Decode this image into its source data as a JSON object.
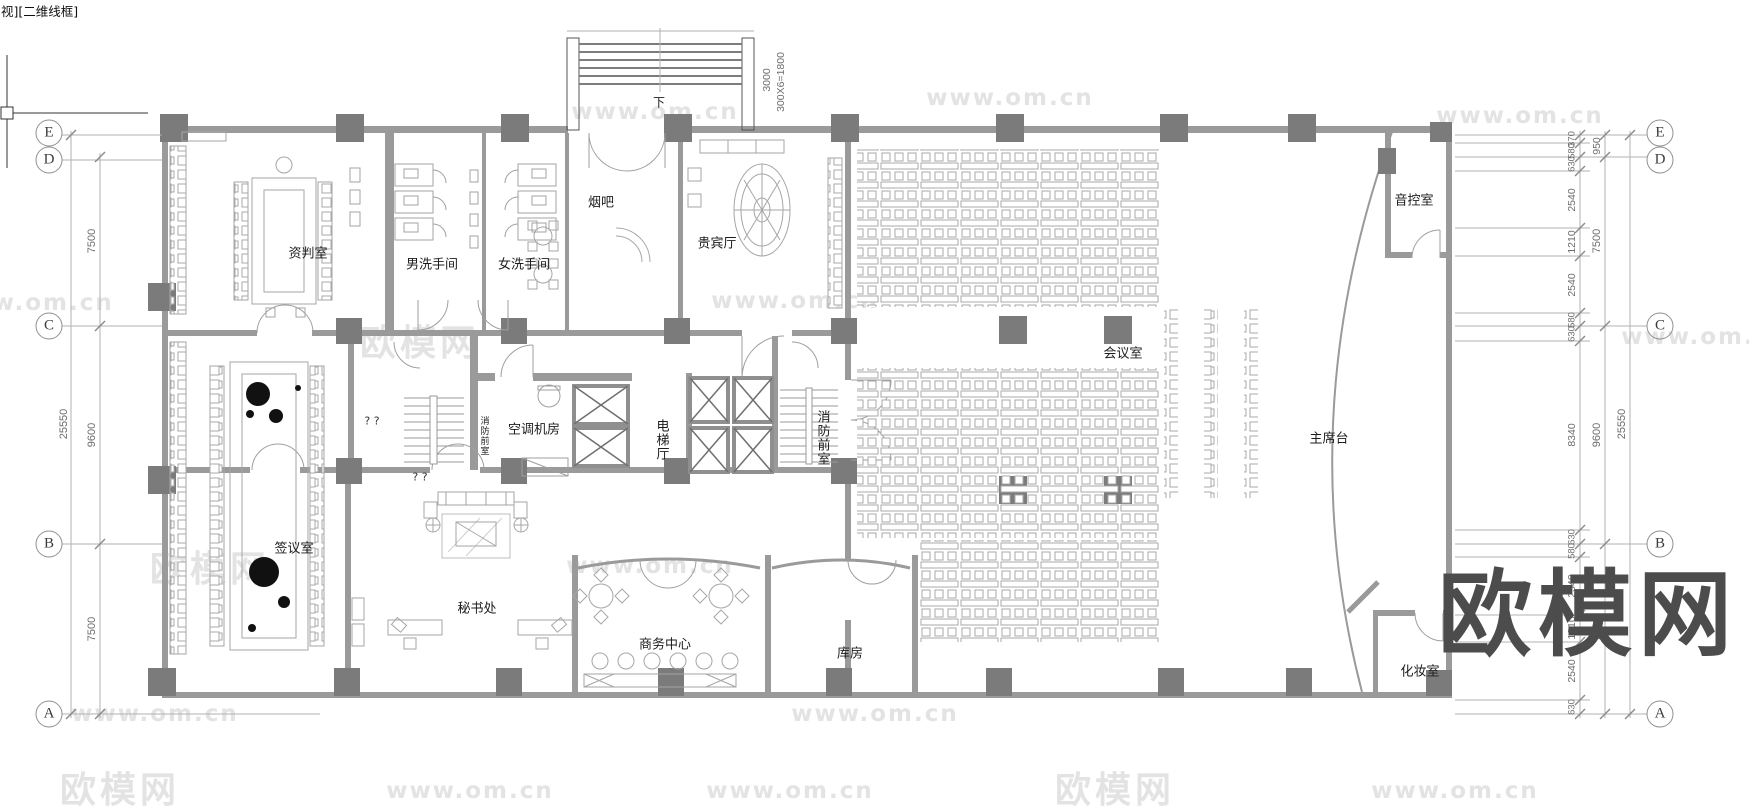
{
  "viewport_label": "视][二维线框]",
  "watermarks": {
    "site": "www.om.cn",
    "brand": "欧模网"
  },
  "grid": {
    "rows": [
      "E",
      "D",
      "C",
      "B",
      "A"
    ]
  },
  "dims": {
    "left": {
      "total": "25550",
      "spans": [
        "7500",
        "9600",
        "7500"
      ]
    },
    "right": {
      "total": "25550",
      "spans": [
        "950",
        "7500",
        "9600",
        "7500"
      ],
      "detail": [
        "370",
        "580",
        "630",
        "2540",
        "1210",
        "2540",
        "580",
        "630",
        "8340",
        "630",
        "580",
        "2540",
        "1210",
        "2540",
        "630"
      ]
    },
    "top": {
      "landing": "3000",
      "steps": "300X6=1800"
    }
  },
  "rooms": {
    "negotiation": "资判室",
    "mens_wc": "男洗手间",
    "womens_wc": "女洗手间",
    "smoking_bar": "烟吧",
    "vip_hall": "贵宾厅",
    "conference": "会议室",
    "audio_control": "音控室",
    "rostrum": "主席台",
    "signing": "签议室",
    "secretariat": "秘书处",
    "business_center": "商务中心",
    "storeroom": "库房",
    "dressing": "化妆室",
    "hvac": "空调机房",
    "elevator_hall": "电梯厅",
    "fire_lobby": "消防前室",
    "fire_lobby_small": "消防前室"
  },
  "annotations": {
    "down": "下",
    "q": "? ?"
  }
}
